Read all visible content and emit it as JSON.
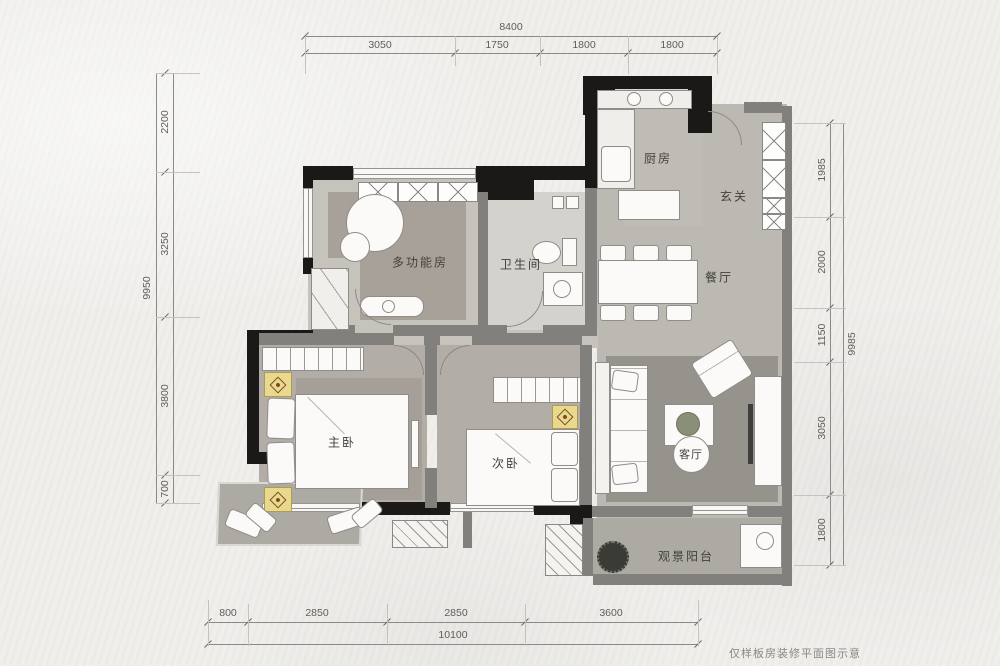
{
  "footer": {
    "note": "仅样板房装修平面图示意"
  },
  "rooms": {
    "kitchen": "厨房",
    "foyer": "玄关",
    "multi": "多功能房",
    "bath": "卫生间",
    "dining": "餐厅",
    "master": "主卧",
    "second": "次卧",
    "living": "客厅",
    "balcony": "观景阳台"
  },
  "dims": {
    "top": {
      "total": "8400",
      "segments": [
        "3050",
        "1750",
        "1800",
        "1800"
      ]
    },
    "left": {
      "total": "9950",
      "segments": [
        "2200",
        "3250",
        "3800",
        "700"
      ]
    },
    "right": {
      "total": "9985",
      "segments": [
        "1985",
        "2000",
        "1150",
        "3050",
        "1800"
      ]
    },
    "bottom": {
      "total": "10100",
      "segments": [
        "800",
        "2850",
        "2850",
        "3600"
      ]
    }
  },
  "colors": {
    "paper": "#f0efec",
    "wall_black": "#1a1918",
    "wall_gray": "#82807c",
    "floor_main": "#bcb9b3",
    "rug_dark": "#96938c",
    "accent_stand": "#e9d98d"
  }
}
